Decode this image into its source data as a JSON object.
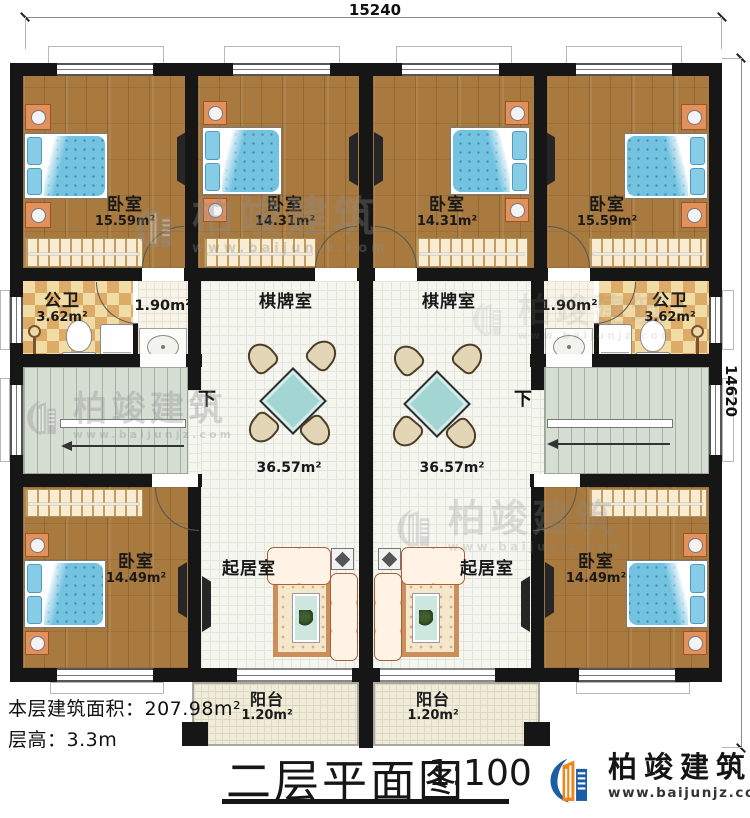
{
  "dimensions": {
    "top": "15240",
    "right": "14620"
  },
  "stairs": {
    "down": "下"
  },
  "rooms": {
    "bedroom_top_left": {
      "name": "卧室",
      "area": "15.59m²"
    },
    "bedroom_top_mid_left": {
      "name": "卧室",
      "area": "14.31m²"
    },
    "bedroom_top_mid_right": {
      "name": "卧室",
      "area": "14.31m²"
    },
    "bedroom_top_right": {
      "name": "卧室",
      "area": "15.59m²"
    },
    "bath_left": {
      "name": "公卫",
      "area": "3.62m²"
    },
    "bath_right": {
      "name": "公卫",
      "area": "3.62m²"
    },
    "wash_left": {
      "area": "1.90m²"
    },
    "wash_right": {
      "area": "1.90m²"
    },
    "games_left": {
      "name": "棋牌室",
      "area": "36.57m²"
    },
    "games_right": {
      "name": "棋牌室",
      "area": "36.57m²"
    },
    "living_left": {
      "name": "起居室"
    },
    "living_right": {
      "name": "起居室"
    },
    "bedroom_bottom_left": {
      "name": "卧室",
      "area": "14.49m²"
    },
    "bedroom_bottom_right": {
      "name": "卧室",
      "area": "14.49m²"
    },
    "balcony_left": {
      "name": "阳台",
      "area": "1.20m²"
    },
    "balcony_right": {
      "name": "阳台",
      "area": "1.20m²"
    }
  },
  "notes": {
    "floor_area": "本层建筑面积：207.98m²",
    "floor_height": "层高：3.3m"
  },
  "title": {
    "text": "二层平面图",
    "scale": "1:100"
  },
  "brand": {
    "name": "柏竣建筑",
    "url": "www.baijunjz.com"
  },
  "watermark": {
    "name": "柏竣建筑",
    "url": "www.baijunjz.com"
  },
  "colors": {
    "wall": "#161616",
    "wood": "#a87a40",
    "tile": "#f6f6f1",
    "checker": "#dcab67",
    "stairs": "#d6ded4",
    "balcony": "#efecd9",
    "bed": "#72c2e0",
    "sofa": "#eda77e",
    "brand_blue": "#1b5ea6",
    "brand_orange": "#f08519"
  }
}
